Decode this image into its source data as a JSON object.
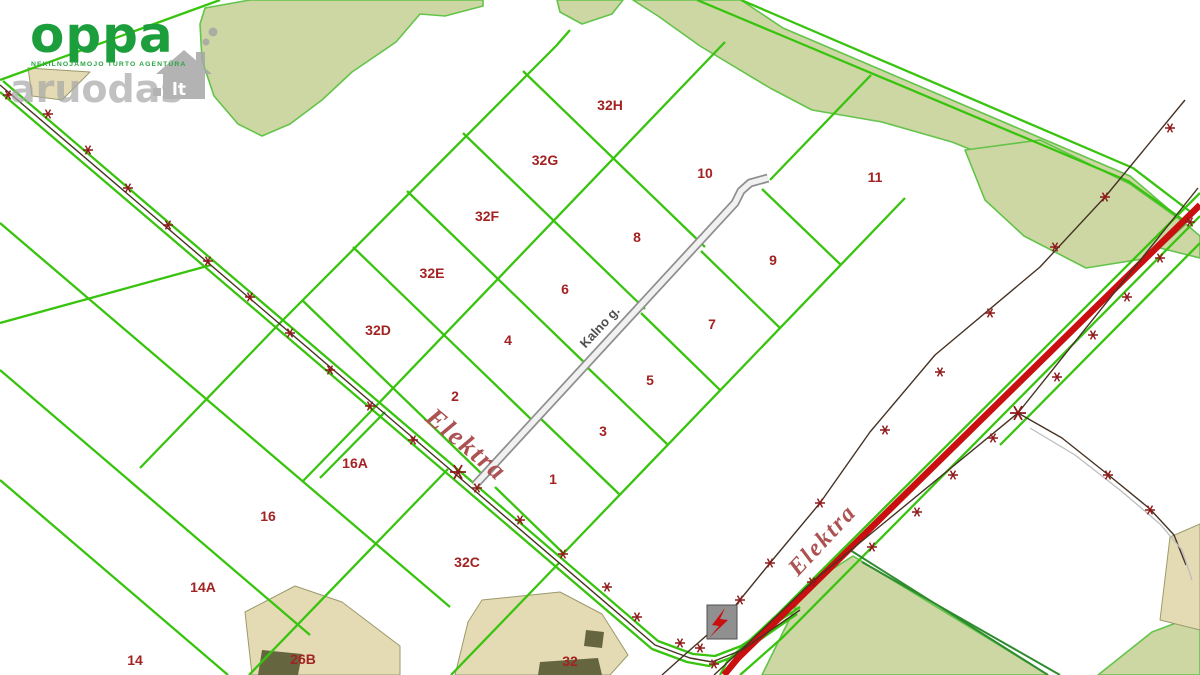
{
  "branding": {
    "logo_text": "oppa",
    "logo_sub": "NEKILNOJAMOJO TURTO AGENTŪRA",
    "logo_color": "#1d9e3d",
    "watermark_text": "aruodas",
    "watermark_lt": "lt",
    "watermark_color": "#a6a6a6"
  },
  "map": {
    "colors": {
      "bg": "#ffffff",
      "line_green": "#38c40e",
      "line_dark_green": "#2e8b2e",
      "veg_fill": "#cdd7a3",
      "veg_stroke": "#63c44a",
      "tan_fill": "#e4dbb5",
      "tan_stroke": "#9a9a6a",
      "building_fill": "#65663f",
      "road_red": "#c90f0f",
      "power_dark": "#463325",
      "marker_red": "#8e1919",
      "label_red": "#a32222",
      "elektra_red": "#ad5252",
      "street_gray": "#4f4f4f",
      "kalno_casing": "#8f8f8f",
      "kalno_fill": "#f1f1f1",
      "gray_curve": "#bdbdbd",
      "transformer_fill": "#909090",
      "transformer_stroke": "#4f4f4f"
    },
    "street_label": {
      "text": "Kalno g.",
      "x": 603,
      "y": 330,
      "rot": -47,
      "size": 13
    },
    "powerline_label": "Elektra",
    "elektra_labels": [
      {
        "x": 424,
        "y": 420,
        "rot": 40,
        "size": 27
      },
      {
        "x": 798,
        "y": 577,
        "rot": -47,
        "size": 24
      }
    ],
    "parcel_labels": [
      {
        "t": "32H",
        "x": 610,
        "y": 110
      },
      {
        "t": "32G",
        "x": 545,
        "y": 165
      },
      {
        "t": "32F",
        "x": 487,
        "y": 221
      },
      {
        "t": "32E",
        "x": 432,
        "y": 278
      },
      {
        "t": "32D",
        "x": 378,
        "y": 335
      },
      {
        "t": "10",
        "x": 705,
        "y": 178
      },
      {
        "t": "11",
        "x": 875,
        "y": 182
      },
      {
        "t": "8",
        "x": 637,
        "y": 242
      },
      {
        "t": "9",
        "x": 773,
        "y": 265
      },
      {
        "t": "6",
        "x": 565,
        "y": 294
      },
      {
        "t": "7",
        "x": 712,
        "y": 329
      },
      {
        "t": "4",
        "x": 508,
        "y": 345
      },
      {
        "t": "5",
        "x": 650,
        "y": 385
      },
      {
        "t": "2",
        "x": 455,
        "y": 401
      },
      {
        "t": "3",
        "x": 603,
        "y": 436
      },
      {
        "t": "1",
        "x": 553,
        "y": 484
      },
      {
        "t": "16A",
        "x": 355,
        "y": 468
      },
      {
        "t": "16",
        "x": 268,
        "y": 521
      },
      {
        "t": "14A",
        "x": 203,
        "y": 592
      },
      {
        "t": "14",
        "x": 135,
        "y": 665
      },
      {
        "t": "26B",
        "x": 303,
        "y": 664
      },
      {
        "t": "32C",
        "x": 467,
        "y": 567
      },
      {
        "t": "32",
        "x": 570,
        "y": 666
      }
    ],
    "veg_polys": [
      [
        [
          205,
          8
        ],
        [
          250,
          0
        ],
        [
          483,
          0
        ],
        [
          483,
          6
        ],
        [
          445,
          16
        ],
        [
          420,
          14
        ],
        [
          396,
          42
        ],
        [
          352,
          72
        ],
        [
          322,
          100
        ],
        [
          290,
          124
        ],
        [
          262,
          136
        ],
        [
          238,
          124
        ],
        [
          214,
          96
        ],
        [
          202,
          60
        ],
        [
          200,
          24
        ]
      ],
      [
        [
          557,
          0
        ],
        [
          623,
          0
        ],
        [
          612,
          14
        ],
        [
          582,
          24
        ],
        [
          560,
          12
        ]
      ],
      [
        [
          633,
          0
        ],
        [
          741,
          0
        ],
        [
          783,
          28
        ],
        [
          1130,
          176
        ],
        [
          1200,
          236
        ],
        [
          1200,
          258
        ],
        [
          1152,
          246
        ],
        [
          1090,
          206
        ],
        [
          1022,
          170
        ],
        [
          952,
          142
        ],
        [
          882,
          122
        ],
        [
          812,
          110
        ],
        [
          770,
          88
        ],
        [
          700,
          46
        ],
        [
          658,
          16
        ]
      ],
      [
        [
          965,
          150
        ],
        [
          1040,
          140
        ],
        [
          1130,
          184
        ],
        [
          1186,
          224
        ],
        [
          1148,
          258
        ],
        [
          1086,
          268
        ],
        [
          1024,
          236
        ],
        [
          985,
          200
        ]
      ],
      [
        [
          853,
          556
        ],
        [
          1048,
          675
        ],
        [
          762,
          675
        ],
        [
          790,
          618
        ],
        [
          806,
          586
        ]
      ],
      [
        [
          1152,
          632
        ],
        [
          1200,
          614
        ],
        [
          1200,
          675
        ],
        [
          1098,
          675
        ]
      ]
    ],
    "tan_polys": [
      [
        [
          28,
          68
        ],
        [
          90,
          72
        ],
        [
          62,
          100
        ],
        [
          32,
          96
        ]
      ],
      [
        [
          482,
          600
        ],
        [
          560,
          592
        ],
        [
          602,
          614
        ],
        [
          628,
          655
        ],
        [
          610,
          675
        ],
        [
          455,
          675
        ],
        [
          468,
          622
        ]
      ],
      [
        [
          245,
          612
        ],
        [
          295,
          586
        ],
        [
          342,
          602
        ],
        [
          400,
          646
        ],
        [
          400,
          675
        ],
        [
          252,
          675
        ]
      ],
      [
        [
          1170,
          537
        ],
        [
          1200,
          524
        ],
        [
          1200,
          630
        ],
        [
          1160,
          620
        ]
      ]
    ],
    "buildings": [
      [
        [
          586,
          630
        ],
        [
          604,
          632
        ],
        [
          602,
          648
        ],
        [
          584,
          646
        ]
      ],
      [
        [
          540,
          662
        ],
        [
          598,
          658
        ],
        [
          602,
          675
        ],
        [
          538,
          675
        ]
      ],
      [
        [
          262,
          650
        ],
        [
          302,
          654
        ],
        [
          298,
          675
        ],
        [
          258,
          675
        ]
      ]
    ],
    "green_lines": [
      [
        [
          570,
          30
        ],
        [
          556,
          46
        ],
        [
          279,
          324
        ]
      ],
      [
        [
          725,
          42
        ],
        [
          376,
          406
        ]
      ],
      [
        [
          905,
          198
        ],
        [
          560,
          557
        ]
      ],
      [
        [
          770,
          180
        ],
        [
          871,
          75
        ]
      ],
      [
        [
          523,
          71
        ],
        [
          705,
          247
        ]
      ],
      [
        [
          463,
          133
        ],
        [
          645,
          309
        ]
      ],
      [
        [
          407,
          191
        ],
        [
          589,
          367
        ]
      ],
      [
        [
          353,
          247
        ],
        [
          535,
          423
        ]
      ],
      [
        [
          302,
          300
        ],
        [
          484,
          476
        ]
      ],
      [
        [
          540,
          418
        ],
        [
          619,
          494
        ]
      ],
      [
        [
          588,
          368
        ],
        [
          667,
          444
        ]
      ],
      [
        [
          641,
          313
        ],
        [
          720,
          390
        ]
      ],
      [
        [
          701,
          251
        ],
        [
          780,
          328
        ]
      ],
      [
        [
          762,
          189
        ],
        [
          841,
          265
        ]
      ],
      [
        [
          495,
          487
        ],
        [
          563,
          553
        ]
      ],
      [
        [
          0,
          323
        ],
        [
          211,
          265
        ]
      ],
      [
        [
          0,
          223
        ],
        [
          450,
          607
        ]
      ],
      [
        [
          0,
          370
        ],
        [
          310,
          635
        ]
      ],
      [
        [
          0,
          480
        ],
        [
          228,
          675
        ]
      ],
      [
        [
          448,
          469
        ],
        [
          249,
          675
        ]
      ],
      [
        [
          385,
          412
        ],
        [
          320,
          478
        ]
      ],
      [
        [
          559,
          563
        ],
        [
          451,
          675
        ]
      ],
      [
        [
          279,
          324
        ],
        [
          140,
          468
        ]
      ],
      [
        [
          376,
          406
        ],
        [
          303,
          481
        ]
      ],
      [
        [
          220,
          0
        ],
        [
          143,
          28
        ],
        [
          0,
          80
        ]
      ],
      [
        [
          741,
          0
        ],
        [
          783,
          18
        ],
        [
          1133,
          168
        ],
        [
          1192,
          213
        ]
      ],
      [
        [
          697,
          0
        ],
        [
          783,
          36
        ],
        [
          1128,
          181
        ],
        [
          1186,
          222
        ]
      ],
      [
        [
          1200,
          193
        ],
        [
          779,
          613
        ],
        [
          750,
          640
        ],
        [
          728,
          660
        ],
        [
          720,
          675
        ]
      ],
      [
        [
          1200,
          216
        ],
        [
          782,
          638
        ],
        [
          748,
          668
        ],
        [
          740,
          675
        ]
      ],
      [
        [
          1200,
          243
        ],
        [
          1000,
          445
        ]
      ],
      [
        [
          3,
          81
        ],
        [
          463,
          474
        ],
        [
          658,
          641
        ],
        [
          693,
          654
        ],
        [
          715,
          656
        ],
        [
          741,
          646
        ],
        [
          800,
          607
        ]
      ],
      [
        [
          0,
          92
        ],
        [
          457,
          482
        ],
        [
          652,
          649
        ],
        [
          687,
          662
        ],
        [
          709,
          666
        ],
        [
          738,
          655
        ],
        [
          797,
          614
        ]
      ]
    ],
    "dark_green_lines": [
      [
        [
          850,
          550
        ],
        [
          1048,
          675
        ]
      ],
      [
        [
          862,
          562
        ],
        [
          1060,
          675
        ]
      ]
    ],
    "kalno_road": [
      [
        768,
        178
      ],
      [
        750,
        183
      ],
      [
        741,
        191
      ],
      [
        735,
        203
      ],
      [
        475,
        485
      ]
    ],
    "red_road": [
      [
        1200,
        205
      ],
      [
        770,
        627
      ],
      [
        738,
        658
      ],
      [
        724,
        675
      ]
    ],
    "power_lines": [
      [
        [
          0,
          85
        ],
        [
          460,
          478
        ],
        [
          655,
          645
        ],
        [
          690,
          658
        ],
        [
          712,
          662
        ],
        [
          742,
          650
        ],
        [
          800,
          610
        ]
      ],
      [
        [
          1198,
          188
        ],
        [
          1018,
          413
        ],
        [
          812,
          582
        ],
        [
          762,
          630
        ],
        [
          728,
          662
        ],
        [
          714,
          675
        ]
      ],
      [
        [
          1185,
          100
        ],
        [
          1105,
          197
        ],
        [
          1040,
          267
        ],
        [
          935,
          355
        ],
        [
          870,
          432
        ],
        [
          820,
          503
        ],
        [
          770,
          563
        ],
        [
          722,
          622
        ],
        [
          690,
          650
        ],
        [
          662,
          675
        ]
      ],
      [
        [
          1018,
          413
        ],
        [
          1062,
          438
        ],
        [
          1106,
          473
        ],
        [
          1150,
          509
        ],
        [
          1174,
          535
        ],
        [
          1186,
          565
        ]
      ]
    ],
    "gray_curves": [
      [
        [
          1030,
          428
        ],
        [
          1075,
          455
        ],
        [
          1120,
          490
        ],
        [
          1160,
          524
        ],
        [
          1182,
          550
        ],
        [
          1192,
          580
        ]
      ]
    ],
    "markers": [
      [
        8,
        95
      ],
      [
        48,
        114
      ],
      [
        88,
        150
      ],
      [
        128,
        188
      ],
      [
        168,
        225
      ],
      [
        208,
        261
      ],
      [
        250,
        297
      ],
      [
        290,
        333
      ],
      [
        330,
        370
      ],
      [
        370,
        406
      ],
      [
        413,
        440
      ],
      [
        477,
        488
      ],
      [
        520,
        520
      ],
      [
        563,
        554
      ],
      [
        607,
        587
      ],
      [
        637,
        617
      ],
      [
        680,
        643
      ],
      [
        714,
        664
      ],
      [
        812,
        582
      ],
      [
        872,
        547
      ],
      [
        917,
        512
      ],
      [
        953,
        475
      ],
      [
        993,
        438
      ],
      [
        1057,
        377
      ],
      [
        1093,
        335
      ],
      [
        1127,
        297
      ],
      [
        1160,
        258
      ],
      [
        1190,
        222
      ],
      [
        1170,
        128
      ],
      [
        1105,
        197
      ],
      [
        1055,
        247
      ],
      [
        990,
        313
      ],
      [
        940,
        372
      ],
      [
        885,
        430
      ],
      [
        820,
        503
      ],
      [
        770,
        563
      ],
      [
        740,
        600
      ],
      [
        700,
        648
      ],
      [
        1108,
        475
      ],
      [
        1150,
        510
      ]
    ],
    "markers_big": [
      [
        458,
        472
      ],
      [
        1018,
        413
      ]
    ],
    "transformer": {
      "x": 707,
      "y": 605,
      "w": 30,
      "h": 34,
      "bolt": [
        [
          725,
          608
        ],
        [
          712,
          625
        ],
        [
          719,
          626
        ],
        [
          709,
          638
        ],
        [
          728,
          620
        ],
        [
          720,
          619
        ]
      ]
    }
  }
}
